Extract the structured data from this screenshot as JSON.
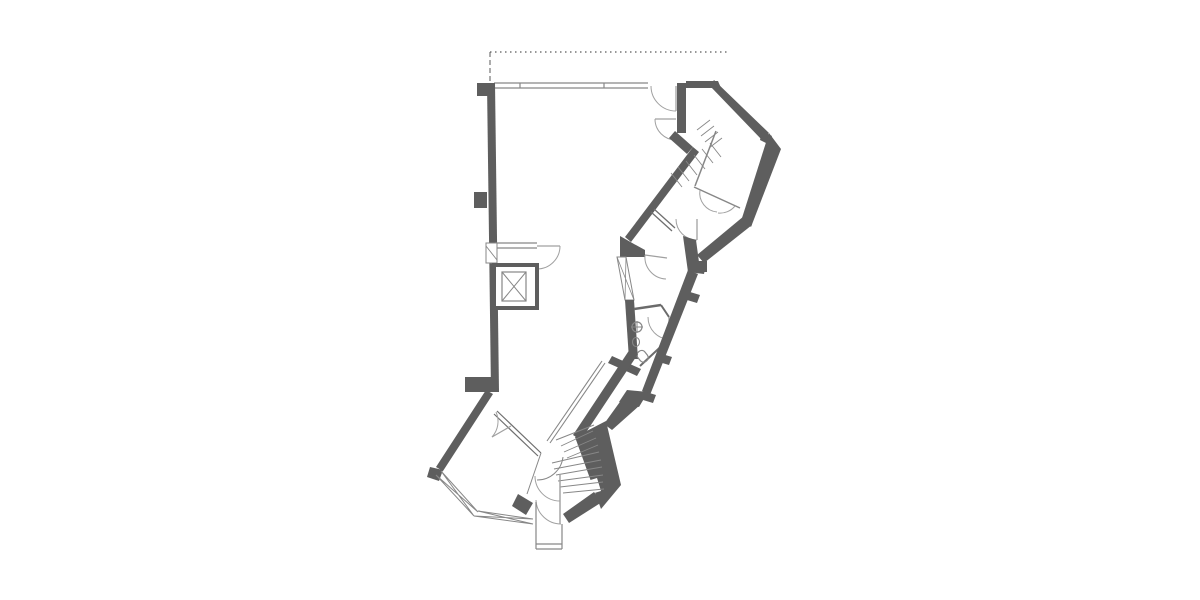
{
  "meta": {
    "label": "architectural-floor-plan"
  },
  "canvas": {
    "width": 1200,
    "height": 600,
    "background": "#ffffff"
  },
  "drawing": {
    "palette": {
      "wall": "#5e5e5e",
      "thin": "#878787",
      "light": "#a0a0a0",
      "dash": "#5a5a5a",
      "white": "#ffffff"
    },
    "shapes": [
      {
        "name": "site-boundary-dotted-line",
        "type": "path",
        "attrs": {
          "d": "M490,52 H727",
          "stroke": "@dash",
          "stroke-width": "1.2",
          "stroke-dasharray": "1.5 3.5",
          "fill": "none"
        }
      },
      {
        "name": "site-boundary-dashed-return",
        "type": "path",
        "attrs": {
          "d": "M490,52 V83",
          "stroke": "@dash",
          "stroke-width": "1",
          "stroke-dasharray": "5 3",
          "fill": "none"
        }
      },
      {
        "name": "top-window-wall",
        "type": "path",
        "attrs": {
          "d": "M494,83 H648 M494,88 H648 M520,83 V88 M604,83 V88",
          "stroke": "@thin",
          "stroke-width": "1.2",
          "fill": "none"
        }
      },
      {
        "name": "left-exterior-wall",
        "type": "polygon",
        "attrs": {
          "points": "487,83 495,83 499,392 491,392",
          "fill": "@wall"
        }
      },
      {
        "name": "left-wall-pilaster-top",
        "type": "rect",
        "attrs": {
          "x": "477",
          "y": "83",
          "width": "18",
          "height": "13",
          "fill": "@wall"
        }
      },
      {
        "name": "left-wall-pilaster-middle",
        "type": "rect",
        "attrs": {
          "x": "474",
          "y": "192",
          "width": "13",
          "height": "16",
          "fill": "@wall"
        }
      },
      {
        "name": "left-wall-pilaster-bottom",
        "type": "rect",
        "attrs": {
          "x": "465",
          "y": "377",
          "width": "27",
          "height": "15",
          "fill": "@wall"
        }
      },
      {
        "name": "elevator-lobby-wall",
        "type": "path",
        "attrs": {
          "d": "M495,243 H537 M495,248 H537",
          "stroke": "@thin",
          "stroke-width": "1.2",
          "fill": "none"
        }
      },
      {
        "name": "elevator-lobby-door-leaf",
        "type": "path",
        "attrs": {
          "d": "M537,246 H560",
          "stroke": "@light",
          "stroke-width": "1.3",
          "fill": "none"
        }
      },
      {
        "name": "elevator-lobby-door-swing",
        "type": "path",
        "attrs": {
          "d": "M560,246 A23 23 0 0 1 537,269",
          "stroke": "@light",
          "stroke-width": "1",
          "fill": "none"
        }
      },
      {
        "name": "left-wall-window-frame",
        "type": "rect",
        "attrs": {
          "x": "486",
          "y": "243",
          "width": "11",
          "height": "20",
          "fill": "@white",
          "stroke": "@thin",
          "stroke-width": "1"
        }
      },
      {
        "name": "left-wall-window-hatch",
        "type": "path",
        "attrs": {
          "d": "M486,246 L497,260",
          "stroke": "@thin",
          "stroke-width": "0.9",
          "fill": "none"
        }
      },
      {
        "name": "elevator-shaft",
        "type": "rect",
        "attrs": {
          "x": "494",
          "y": "265",
          "width": "43",
          "height": "43",
          "fill": "@white",
          "stroke": "@wall",
          "stroke-width": "4"
        }
      },
      {
        "name": "elevator-car",
        "type": "rect",
        "attrs": {
          "x": "502",
          "y": "272",
          "width": "24",
          "height": "29",
          "fill": "none",
          "stroke": "@thin",
          "stroke-width": "1.2"
        }
      },
      {
        "name": "elevator-car-cross",
        "type": "path",
        "attrs": {
          "d": "M502,272 L526,301 M526,272 L502,301",
          "stroke": "@thin",
          "stroke-width": "1",
          "fill": "none"
        }
      },
      {
        "name": "top-wall-right-segment",
        "type": "polygon",
        "attrs": {
          "points": "686,81 718,81 721,88 686,88",
          "fill": "@wall"
        }
      },
      {
        "name": "entry-door-jamb-wall",
        "type": "rect",
        "attrs": {
          "x": "677",
          "y": "83",
          "width": "9",
          "height": "50",
          "fill": "@wall"
        }
      },
      {
        "name": "main-entry-door-1-leaf",
        "type": "path",
        "attrs": {
          "d": "M676,86 V111",
          "stroke": "@light",
          "stroke-width": "1.3",
          "fill": "none"
        }
      },
      {
        "name": "main-entry-door-1-swing",
        "type": "path",
        "attrs": {
          "d": "M651,86 A25 25 0 0 0 676,111",
          "stroke": "@light",
          "stroke-width": "1",
          "fill": "none"
        }
      },
      {
        "name": "main-entry-door-2-leaf",
        "type": "path",
        "attrs": {
          "d": "M655,119 H676",
          "stroke": "@light",
          "stroke-width": "1.3",
          "fill": "none"
        }
      },
      {
        "name": "main-entry-door-2-swing",
        "type": "path",
        "attrs": {
          "d": "M655,119 A21 21 0 0 0 676,140",
          "stroke": "@light",
          "stroke-width": "1",
          "fill": "none"
        }
      },
      {
        "name": "wall-elbow",
        "type": "polygon",
        "attrs": {
          "points": "675,131 693,147 687,154 669,138",
          "fill": "@wall"
        }
      },
      {
        "name": "main-diagonal-wall",
        "type": "polygon",
        "attrs": {
          "points": "693,147 699,152 631,242 625,237",
          "fill": "@wall"
        }
      },
      {
        "name": "diagonal-corner-block",
        "type": "polygon",
        "attrs": {
          "points": "620,236 634,244 645,250 645,257 620,257",
          "fill": "@wall"
        }
      },
      {
        "name": "mid-window-band-frame",
        "type": "polygon",
        "attrs": {
          "points": "617,257 626,257 634,300 625,300",
          "fill": "@white",
          "stroke": "@thin",
          "stroke-width": "1"
        }
      },
      {
        "name": "mid-window-band-hatch",
        "type": "path",
        "attrs": {
          "d": "M617,257 L634,300 M626,257 L625,300",
          "stroke": "@thin",
          "stroke-width": "0.8",
          "fill": "none"
        }
      },
      {
        "name": "wc-left-wall",
        "type": "polygon",
        "attrs": {
          "points": "625,300 634,300 638,359 629,359",
          "fill": "@wall"
        }
      },
      {
        "name": "wc-top-wall",
        "type": "path",
        "attrs": {
          "d": "M634,309 L661,305",
          "stroke": "#6b6b6b",
          "stroke-width": "2.5",
          "fill": "none"
        }
      },
      {
        "name": "wc-corner-wall",
        "type": "path",
        "attrs": {
          "d": "M661,305 L669,317",
          "stroke": "#6b6b6b",
          "stroke-width": "2",
          "fill": "none"
        }
      },
      {
        "name": "wc-door-leaf",
        "type": "path",
        "attrs": {
          "d": "M669,317 V339",
          "stroke": "@light",
          "stroke-width": "1.3",
          "fill": "none"
        }
      },
      {
        "name": "wc-door-swing",
        "type": "path",
        "attrs": {
          "d": "M648,317 A21 22 0 0 0 669,339",
          "stroke": "@light",
          "stroke-width": "1",
          "fill": "none"
        }
      },
      {
        "name": "wc-bottom-wall-line",
        "type": "path",
        "attrs": {
          "d": "M669,339 L640,366",
          "stroke": "#6b6b6b",
          "stroke-width": "2",
          "fill": "none"
        }
      },
      {
        "name": "wc-bottom-wall-thick",
        "type": "polygon",
        "attrs": {
          "points": "612,356 641,369 637,376 608,363",
          "fill": "@wall"
        }
      },
      {
        "name": "wc-sink",
        "type": "circle",
        "attrs": {
          "cx": "637",
          "cy": "327",
          "r": "5",
          "fill": "none",
          "stroke": "@thin",
          "stroke-width": "1.2"
        }
      },
      {
        "name": "wc-sink-cross",
        "type": "path",
        "attrs": {
          "d": "M631,327 H643 M637,321 V333",
          "stroke": "@thin",
          "stroke-width": "1",
          "fill": "none"
        }
      },
      {
        "name": "wc-basin",
        "type": "ellipse",
        "attrs": {
          "cx": "636",
          "cy": "342",
          "rx": "3.5",
          "ry": "4.5",
          "fill": "none",
          "stroke": "@thin",
          "stroke-width": "1.1"
        }
      },
      {
        "name": "wc-toilet",
        "type": "rect",
        "attrs": {
          "x": "638",
          "y": "350",
          "width": "9",
          "height": "12",
          "rx": "4",
          "fill": "none",
          "stroke": "@thin",
          "stroke-width": "1.2",
          "transform": "rotate(-38 643 356)"
        }
      },
      {
        "name": "corridor-left-wall",
        "type": "path",
        "attrs": {
          "d": "M602,361 L547,441 M605,363 L550,443",
          "stroke": "@thin",
          "stroke-width": "1.1",
          "fill": "none"
        }
      },
      {
        "name": "corridor-right-wall",
        "type": "polygon",
        "attrs": {
          "points": "630,349 638,354 581,440 573,435",
          "fill": "@wall"
        }
      },
      {
        "name": "wing-top-edge-wall",
        "type": "polygon",
        "attrs": {
          "points": "714,80 769,133 762,140 710,86",
          "fill": "@wall"
        }
      },
      {
        "name": "wing-corner-notch",
        "type": "polygon",
        "attrs": {
          "points": "762,131 772,136 768,144 760,140",
          "fill": "@wall"
        }
      },
      {
        "name": "wing-right-edge-wall",
        "type": "polygon",
        "attrs": {
          "points": "769,133 781,149 751,227 742,218",
          "fill": "@wall"
        }
      },
      {
        "name": "wing-bottom-edge-wall",
        "type": "polygon",
        "attrs": {
          "points": "744,216 752,225 704,263 697,255",
          "fill": "@wall"
        }
      },
      {
        "name": "wing-room-separator",
        "type": "path",
        "attrs": {
          "d": "M716,131 L695,186",
          "stroke": "@thin",
          "stroke-width": "1.5",
          "fill": "none"
        }
      },
      {
        "name": "wing-room-bottom-line",
        "type": "path",
        "attrs": {
          "d": "M694,187 L740,208",
          "stroke": "@thin",
          "stroke-width": "1.5",
          "fill": "none"
        }
      },
      {
        "name": "wing-stair-treads",
        "type": "path",
        "attrs": {
          "d": "M697,130 L710,120 M701,136 L714,126 M705,142 L718,132 M709,148 L722,138 M710,143 L721,157 M702,149 L713,163 M694,155 L705,169 M686,161 L697,175 M678,167 L689,181 M671,173 L682,187",
          "stroke": "@thin",
          "stroke-width": "0.9",
          "fill": "none"
        }
      },
      {
        "name": "wing-door-swing-left",
        "type": "path",
        "attrs": {
          "d": "M700,190 A19 19 0 0 0 717,212",
          "stroke": "@light",
          "stroke-width": "1",
          "fill": "none"
        }
      },
      {
        "name": "wing-door-swing-right",
        "type": "path",
        "attrs": {
          "d": "M735,206 A19 19 0 0 1 718,213",
          "stroke": "@light",
          "stroke-width": "1",
          "fill": "none"
        }
      },
      {
        "name": "room-partition-upper",
        "type": "path",
        "attrs": {
          "d": "M651,212 L672,231 M654,209 L675,228",
          "stroke": "#6f6f6f",
          "stroke-width": "1.3",
          "fill": "none"
        }
      },
      {
        "name": "room-a-door-leaf",
        "type": "path",
        "attrs": {
          "d": "M697,219 V240",
          "stroke": "@light",
          "stroke-width": "1.3",
          "fill": "none"
        }
      },
      {
        "name": "room-a-door-swing",
        "type": "path",
        "attrs": {
          "d": "M676,219 A21 21 0 0 0 697,240",
          "stroke": "@light",
          "stroke-width": "1",
          "fill": "none"
        }
      },
      {
        "name": "room-b-door-leaf",
        "type": "path",
        "attrs": {
          "d": "M645,255 L667,258",
          "stroke": "@light",
          "stroke-width": "1.3",
          "fill": "none"
        }
      },
      {
        "name": "room-b-door-swing",
        "type": "path",
        "attrs": {
          "d": "M645,255 A22 22 0 0 0 666,279",
          "stroke": "@light",
          "stroke-width": "1",
          "fill": "none"
        }
      },
      {
        "name": "outer-wall-jog-block",
        "type": "polygon",
        "attrs": {
          "points": "683,236 696,240 699,262 706,264 704,274 688,272",
          "fill": "@wall"
        }
      },
      {
        "name": "outer-wall-jog-nub",
        "type": "rect",
        "attrs": {
          "x": "695",
          "y": "261",
          "width": "12",
          "height": "11",
          "fill": "@wall"
        }
      },
      {
        "name": "outer-wall-lower-diagonal",
        "type": "polygon",
        "attrs": {
          "points": "688,270 698,274 650,395 642,391",
          "fill": "@wall"
        }
      },
      {
        "name": "outer-wall-pier-1",
        "type": "polygon",
        "attrs": {
          "points": "690,292 700,295 697,303 687,300",
          "fill": "@wall"
        }
      },
      {
        "name": "outer-wall-pier-2",
        "type": "polygon",
        "attrs": {
          "points": "662,354 672,357 669,365 659,362",
          "fill": "@wall"
        }
      },
      {
        "name": "outer-wall-pier-3",
        "type": "polygon",
        "attrs": {
          "points": "646,392 656,395 653,403 643,400",
          "fill": "@wall"
        }
      },
      {
        "name": "outer-wall-merge-block",
        "type": "polygon",
        "attrs": {
          "points": "627,390 648,392 639,407 619,402",
          "fill": "@wall"
        }
      },
      {
        "name": "outer-wall-to-stair",
        "type": "polygon",
        "attrs": {
          "points": "622,399 640,405 612,430 604,424",
          "fill": "@wall"
        }
      },
      {
        "name": "bottom-left-diagonal-wall",
        "type": "polygon",
        "attrs": {
          "points": "486,390 493,394 443,471 436,467",
          "fill": "@wall"
        }
      },
      {
        "name": "bottom-left-corner-block",
        "type": "polygon",
        "attrs": {
          "points": "430,467 443,470 439,481 427,477",
          "fill": "@wall"
        }
      },
      {
        "name": "window-band-a",
        "type": "path",
        "attrs": {
          "d": "M436,475 L474,516 M441,471 L478,512 M436,475 L478,512 M441,471 L474,516",
          "stroke": "@thin",
          "stroke-width": "1",
          "fill": "none"
        }
      },
      {
        "name": "window-band-b",
        "type": "path",
        "attrs": {
          "d": "M474,516 L533,524 M478,511 L533,519 M474,516 L533,519 M478,511 L533,524",
          "stroke": "@thin",
          "stroke-width": "1",
          "fill": "none"
        }
      },
      {
        "name": "bottom-room-partition-wall",
        "type": "path",
        "attrs": {
          "d": "M497,411 L541,453 M494,414 L538,456",
          "stroke": "#6f6f6f",
          "stroke-width": "1.2",
          "fill": "none"
        }
      },
      {
        "name": "bottom-room-door-leaf",
        "type": "path",
        "attrs": {
          "d": "M511,426 L492,437",
          "stroke": "@light",
          "stroke-width": "1.2",
          "fill": "none"
        }
      },
      {
        "name": "bottom-room-door-swing",
        "type": "path",
        "attrs": {
          "d": "M496,412 A23 23 0 0 1 492,437",
          "stroke": "@light",
          "stroke-width": "1",
          "fill": "none"
        }
      },
      {
        "name": "bottom-room-side-line",
        "type": "path",
        "attrs": {
          "d": "M541,453 L527,494",
          "stroke": "@thin",
          "stroke-width": "1",
          "fill": "none"
        }
      },
      {
        "name": "stair-right-wall",
        "type": "polygon",
        "attrs": {
          "points": "575,437 606,421 621,485 601,509",
          "fill": "@wall"
        }
      },
      {
        "name": "stair-wall-niche",
        "type": "polygon",
        "attrs": {
          "points": "584,482 597,478 601,491 588,495",
          "fill": "@white"
        }
      },
      {
        "name": "entry-side-wall",
        "type": "polygon",
        "attrs": {
          "points": "563,514 594,492 602,502 569,523",
          "fill": "@wall"
        }
      },
      {
        "name": "entry-left-post",
        "type": "polygon",
        "attrs": {
          "points": "518,494 533,503 526,515 512,506",
          "fill": "@wall"
        }
      },
      {
        "name": "stair-top-edge",
        "type": "path",
        "attrs": {
          "d": "M556,440 L594,425",
          "stroke": "@thin",
          "stroke-width": "1",
          "fill": "none"
        }
      },
      {
        "name": "stair-treads",
        "type": "path",
        "attrs": {
          "d": "M561,446 L593,431 M564,452 L596,438 M567,458 L598,445 M552,463 L599,452 M554,469 L601,460 M556,475 L602,467 M558,481 L603,475 M560,487 L603,482 M563,493 L604,489",
          "stroke": "@thin",
          "stroke-width": "0.9",
          "fill": "none"
        }
      },
      {
        "name": "stair-winder-curve",
        "type": "path",
        "attrs": {
          "d": "M537,480 A26 26 0 0 0 563,457",
          "stroke": "@thin",
          "stroke-width": "1",
          "fill": "none"
        }
      },
      {
        "name": "entrance-door-leaf",
        "type": "path",
        "attrs": {
          "d": "M560,474 V524",
          "stroke": "@light",
          "stroke-width": "1.4",
          "fill": "none"
        }
      },
      {
        "name": "entrance-door-swing-upper",
        "type": "path",
        "attrs": {
          "d": "M535,476 A25 25 0 0 0 560,501",
          "stroke": "@light",
          "stroke-width": "1",
          "fill": "none"
        }
      },
      {
        "name": "entrance-door-swing-lower",
        "type": "path",
        "attrs": {
          "d": "M536,500 A25 25 0 0 0 561,524",
          "stroke": "@light",
          "stroke-width": "1",
          "fill": "none"
        }
      },
      {
        "name": "entrance-vestibule",
        "type": "path",
        "attrs": {
          "d": "M536,502 V549 M562,524 V549 M536,544 H562 M536,549 H562",
          "stroke": "@thin",
          "stroke-width": "1.2",
          "fill": "none"
        }
      }
    ]
  }
}
